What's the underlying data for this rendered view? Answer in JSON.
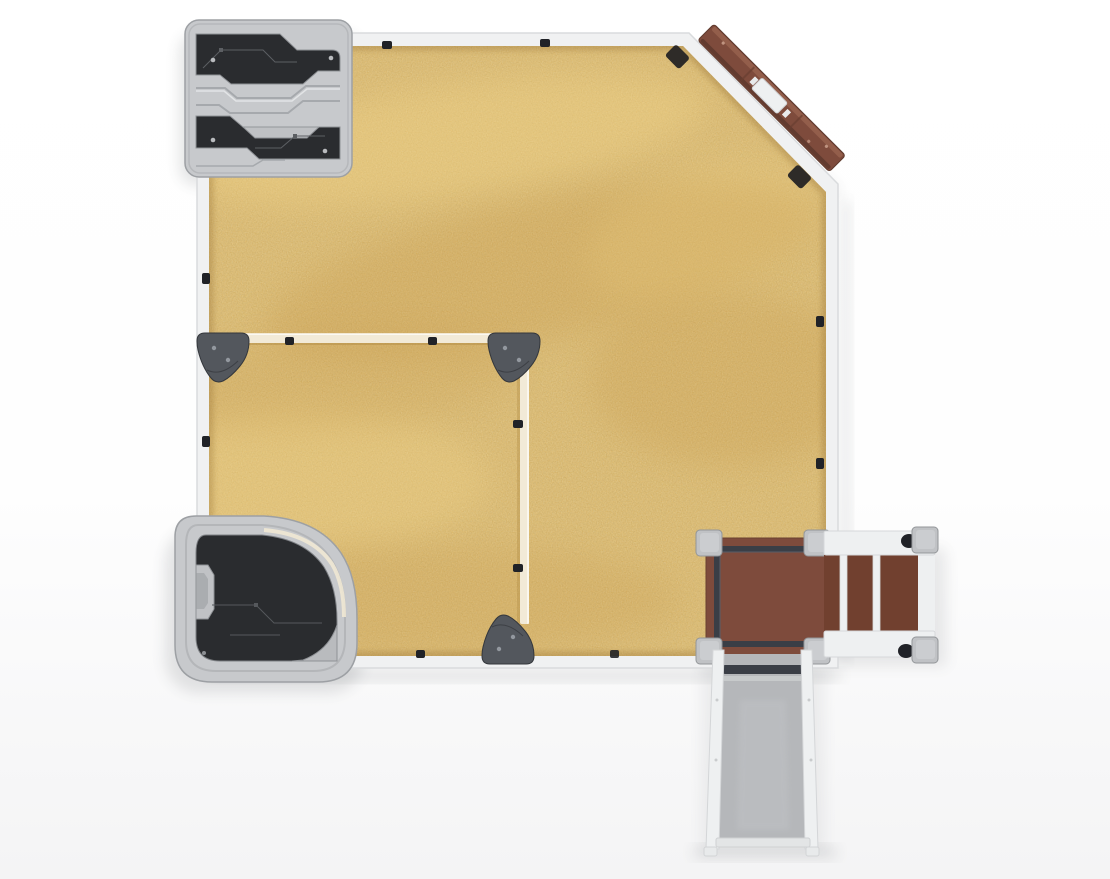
{
  "scene": {
    "title": "Sandbox play structure - top view render",
    "view": "top-down"
  },
  "colors": {
    "background": "#fdfdfe",
    "frame": "#f0f1f2",
    "frame_edge": "#d9dbdd",
    "sand": "#e0b155",
    "sand_dark": "#bd8c3a",
    "sand_light": "#f4d88c",
    "divider": "#f2ead7",
    "cap": "#53575d",
    "panel_light": "#c7c9cc",
    "panel_mid": "#a9acb0",
    "panel_dark": "#2a2c2f",
    "wood": "#7e4b3c",
    "wood_dark": "#5f3a2e",
    "steps_wood": "#71402f",
    "rail_dark": "#3a3e46",
    "slide": "#b5b7ba",
    "white_part": "#eef0f1",
    "post": "#c0c2c5",
    "clip": "#202227",
    "shadow": "#3a3f45"
  },
  "components": {
    "sandbox": "sandbox-frame",
    "sand": "sand-surface",
    "divider": "inner-partition",
    "corner_caps": "corner-cap",
    "maze_panel": "play-panel-top-left",
    "quarter_panel": "quarter-play-panel-bottom-left",
    "balance_beam": "diagonal-balance-beam",
    "deck": "platform-deck",
    "steps": "access-steps",
    "slide": "slide"
  }
}
